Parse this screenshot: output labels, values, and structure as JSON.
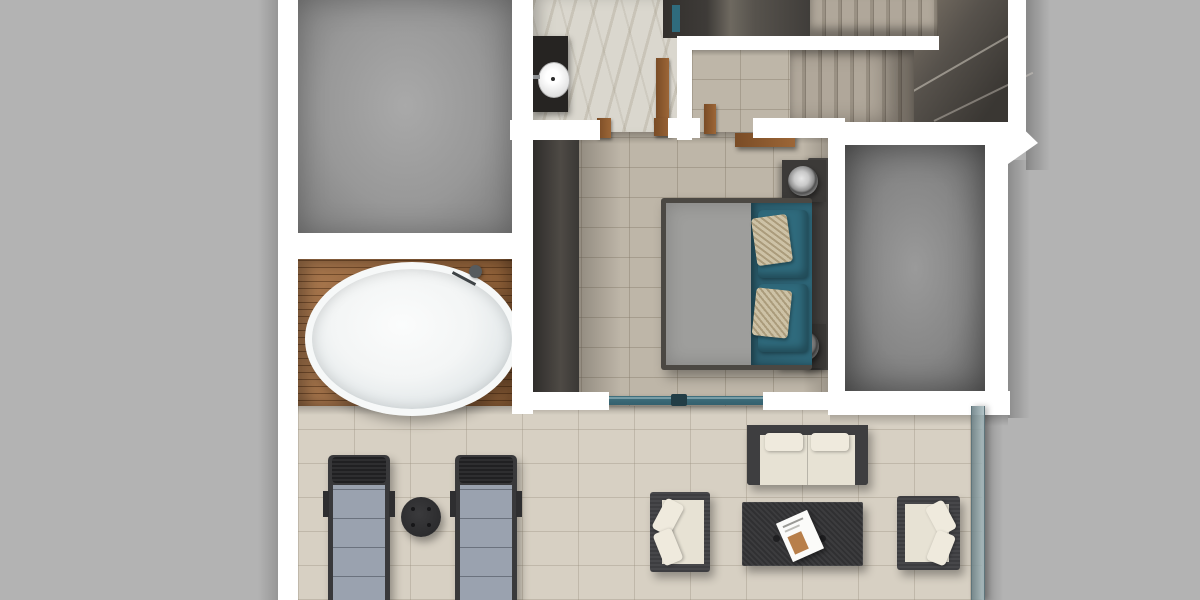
{
  "scene": {
    "type": "3d-floor-plan-top-down-render",
    "description": "Top-down 3D rendered floor plan: two gray rooms, marble bathroom with vanity sink, wooden bath deck with freestanding oval tub, U-shaped staircase, bedroom with teal bedding, and a tiled terrace with outdoor lounge furniture",
    "rooms": [
      {
        "name": "room-top-left",
        "floor": "gray-concrete"
      },
      {
        "name": "bath-deck",
        "floor": "wood-slats",
        "fixtures": [
          "freestanding-oval-bathtub",
          "floor-standing-faucet"
        ]
      },
      {
        "name": "bathroom",
        "floor": "marble",
        "fixtures": [
          "dark-vanity-counter",
          "round-white-sink",
          "dark-wardrobe-nook",
          "open-wood-door"
        ]
      },
      {
        "name": "hallway-landing",
        "floor": "beige-tile",
        "fixtures": [
          "open-wood-door"
        ]
      },
      {
        "name": "staircase",
        "features": [
          "upper-flight",
          "lower-flight",
          "winder-corner",
          "white-half-wall-rail"
        ]
      },
      {
        "name": "bedroom",
        "floor": "beige-tile",
        "furniture": [
          "double-bed-gray-duvet",
          "teal-bed-runner",
          "teal-pillows",
          "patterned-accent-pillows",
          "dark-headboard",
          "two-nightstands",
          "two-round-table-lamps",
          "wall-mounted-wood-desk",
          "built-in-wardrobe-band",
          "teal-sliding-glass-door"
        ]
      },
      {
        "name": "room-right",
        "floor": "gray-concrete"
      },
      {
        "name": "terrace",
        "floor": "light-beige-tile",
        "furniture": [
          "sun-lounger",
          "sun-lounger",
          "round-side-table",
          "outdoor-sofa",
          "wicker-coffee-table",
          "magazine",
          "outdoor-armchair",
          "outdoor-armchair",
          "glass-railing"
        ]
      }
    ]
  },
  "colors": {
    "background": "#b3b3b3",
    "wall": "#ffffff",
    "room_gray_center": "#a9a9a9",
    "room_gray_edge": "#7d7d7d",
    "roomb_center": "#9a9a9a",
    "roomb_edge": "#666666",
    "tile_warm": "#beb6a8",
    "tile_warm_line": "rgba(130,120,102,0.40)",
    "tile_light": "#d7d0c3",
    "tile_light_line": "rgba(150,140,122,0.35)",
    "marble": "#dad7ce",
    "marble_vein": "rgba(150,140,118,0.25)",
    "wood_deck": "#a06b3e",
    "wood_door": "#9c6637",
    "dark_furniture": "#3c3a38",
    "vanity_dark": "#262422",
    "stair_tread": "#b0a79a",
    "stair_tread_dark": "#9a9184",
    "stair_wedge_dark": "#3a3733",
    "teal_bedding": "#2d6577",
    "teal_pillow": "#2f6a7c",
    "teal_accent": "#2f6b7d",
    "teal_door": "#34606e",
    "duvet_gray": "#9e9e9c",
    "bedframe": "#4b4843",
    "headboard": "#454341",
    "accent_pillow": "#cdc2a6",
    "cream_cushion": "#e7e2d4",
    "cream_pillow": "#efeadd",
    "outdoor_frame": "#47474a",
    "outdoor_frame_dark": "#39393b",
    "lounger_cushion": "#9aa2af",
    "table_dark": "#2c2c2e",
    "tub_white": "#f3f5f5",
    "glass_rail": "#7e959b"
  }
}
